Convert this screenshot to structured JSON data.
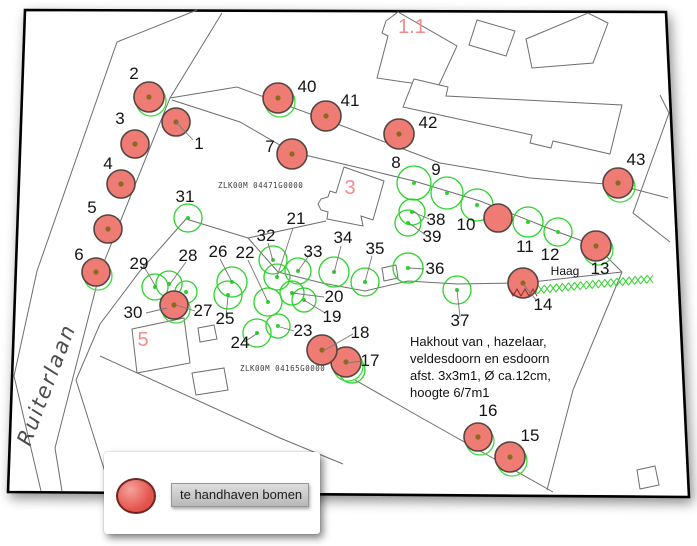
{
  "legend": {
    "label": "te handhaven bomen",
    "swatch_color": "#e4564d"
  },
  "map": {
    "frame": [
      [
        25,
        10
      ],
      [
        666,
        12
      ],
      [
        689,
        497
      ],
      [
        8,
        492
      ]
    ],
    "street": {
      "name": "Ruiterlaan",
      "x": 30,
      "y": 447,
      "rotation": -69
    },
    "haag": {
      "label": "Haag",
      "x": 565,
      "y": 275
    },
    "note": {
      "x": 410,
      "y": 346,
      "line_height": 17,
      "lines": [
        "Hakhout van , hazelaar,",
        "veldesdoorn en esdoorn",
        "afst. 3x3m1, Ø ca.12cm,",
        "hoogte 6/7m1"
      ]
    },
    "parcel_codes": [
      {
        "text": "ZLK00M 04471G0000",
        "x": 218,
        "y": 188
      },
      {
        "text": "ZLK00M 04165G0000",
        "x": 240,
        "y": 371
      }
    ],
    "red_refs": [
      {
        "t": "1.1",
        "x": 412,
        "y": 33,
        "size": 21
      },
      {
        "t": "3",
        "x": 350,
        "y": 194,
        "size": 21
      },
      {
        "t": "5",
        "x": 143,
        "y": 346,
        "size": 22
      }
    ],
    "roads": [
      [
        [
          197,
          10
        ],
        [
          117,
          42
        ],
        [
          37,
          271
        ],
        [
          14,
          376
        ],
        [
          41,
          491
        ]
      ],
      [
        [
          222,
          13
        ],
        [
          170,
          98
        ],
        [
          100,
          272
        ],
        [
          55,
          448
        ],
        [
          62,
          491
        ]
      ],
      [
        [
          326,
          221
        ],
        [
          248,
          238
        ],
        [
          186,
          219
        ],
        [
          140,
          271
        ],
        [
          100,
          324
        ],
        [
          76,
          380
        ],
        [
          111,
          491
        ]
      ],
      [
        [
          170,
          98
        ],
        [
          237,
          87
        ],
        [
          340,
          125
        ],
        [
          440,
          163
        ],
        [
          530,
          178
        ],
        [
          618,
          185
        ],
        [
          668,
          198
        ]
      ],
      [
        [
          172,
          100
        ],
        [
          240,
          122
        ],
        [
          292,
          152
        ],
        [
          360,
          168
        ],
        [
          414,
          181
        ],
        [
          480,
          201
        ],
        [
          558,
          232
        ],
        [
          596,
          246
        ],
        [
          622,
          272
        ]
      ],
      [
        [
          248,
          238
        ],
        [
          278,
          272
        ],
        [
          322,
          283
        ],
        [
          365,
          291
        ],
        [
          408,
          281
        ],
        [
          457,
          284
        ],
        [
          520,
          283
        ]
      ],
      [
        [
          523,
          283
        ],
        [
          622,
          272
        ]
      ],
      [
        [
          660,
          95
        ],
        [
          669,
          113
        ],
        [
          633,
          213
        ],
        [
          670,
          242
        ]
      ],
      [
        [
          100,
          356
        ],
        [
          280,
          438
        ],
        [
          343,
          464
        ]
      ],
      [
        [
          355,
          380
        ],
        [
          420,
          417
        ],
        [
          553,
          492
        ]
      ],
      [
        [
          622,
          272
        ],
        [
          573,
          390
        ],
        [
          547,
          490
        ]
      ]
    ],
    "buildings": [
      [
        [
          377,
          78
        ],
        [
          388,
          36
        ],
        [
          382,
          33
        ],
        [
          386,
          21
        ],
        [
          398,
          12
        ],
        [
          457,
          46
        ],
        [
          438,
          87
        ]
      ],
      [
        [
          477,
          20
        ],
        [
          515,
          31
        ],
        [
          506,
          56
        ],
        [
          469,
          45
        ]
      ],
      [
        [
          526,
          39
        ],
        [
          588,
          13
        ],
        [
          608,
          23
        ],
        [
          593,
          63
        ],
        [
          532,
          68
        ]
      ],
      [
        [
          403,
          107
        ],
        [
          414,
          79
        ],
        [
          448,
          87
        ],
        [
          446,
          96
        ],
        [
          622,
          105
        ],
        [
          610,
          154
        ],
        [
          553,
          141
        ],
        [
          551,
          148
        ],
        [
          530,
          143
        ],
        [
          532,
          135
        ]
      ],
      [
        [
          344,
          167
        ],
        [
          384,
          181
        ],
        [
          373,
          220
        ],
        [
          361,
          216
        ],
        [
          363,
          226
        ],
        [
          327,
          219
        ],
        [
          328,
          212
        ],
        [
          321,
          210
        ],
        [
          318,
          204
        ],
        [
          321,
          199
        ],
        [
          328,
          197
        ],
        [
          330,
          191
        ],
        [
          336,
          193
        ]
      ],
      [
        [
          132,
          329
        ],
        [
          184,
          318
        ],
        [
          190,
          363
        ],
        [
          137,
          373
        ]
      ],
      [
        [
          198,
          328
        ],
        [
          214,
          325
        ],
        [
          217,
          339
        ],
        [
          200,
          342
        ]
      ],
      [
        [
          192,
          373
        ],
        [
          224,
          368
        ],
        [
          228,
          390
        ],
        [
          196,
          395
        ]
      ],
      [
        [
          382,
          268
        ],
        [
          396,
          265
        ],
        [
          398,
          278
        ],
        [
          384,
          281
        ]
      ],
      [
        [
          637,
          470
        ],
        [
          655,
          466
        ],
        [
          659,
          485
        ],
        [
          640,
          489
        ]
      ]
    ],
    "hedge": {
      "x1": 535,
      "y1": 290,
      "x2": 650,
      "y2": 279
    },
    "trees_red": [
      {
        "n": "1",
        "x": 176,
        "y": 122,
        "r": 14,
        "halo": false
      },
      {
        "n": "2",
        "x": 149,
        "y": 97,
        "r": 15,
        "halo": true
      },
      {
        "n": "3",
        "x": 135,
        "y": 144,
        "r": 14,
        "halo": false
      },
      {
        "n": "4",
        "x": 121,
        "y": 184,
        "r": 14,
        "halo": false
      },
      {
        "n": "5",
        "x": 108,
        "y": 229,
        "r": 14,
        "halo": false
      },
      {
        "n": "6",
        "x": 96,
        "y": 272,
        "r": 14,
        "halo": true
      },
      {
        "n": "7",
        "x": 292,
        "y": 154,
        "r": 15,
        "halo": false
      },
      {
        "n": "10",
        "x": 498,
        "y": 218,
        "r": 14,
        "halo": false,
        "dot": false
      },
      {
        "n": "13",
        "x": 596,
        "y": 246,
        "r": 15,
        "halo": true
      },
      {
        "n": "14",
        "x": 523,
        "y": 283,
        "r": 15,
        "halo": false,
        "hatch": true
      },
      {
        "n": "15",
        "x": 510,
        "y": 457,
        "r": 15,
        "halo": true
      },
      {
        "n": "16",
        "x": 478,
        "y": 437,
        "r": 14,
        "halo": true
      },
      {
        "n": "17",
        "x": 346,
        "y": 362,
        "r": 15,
        "halo": true
      },
      {
        "n": "18",
        "x": 322,
        "y": 350,
        "r": 15,
        "halo": false
      },
      {
        "n": "27",
        "x": 174,
        "y": 305,
        "r": 14,
        "halo": true
      },
      {
        "n": "40",
        "x": 278,
        "y": 98,
        "r": 15,
        "halo": true
      },
      {
        "n": "41",
        "x": 326,
        "y": 116,
        "r": 15,
        "halo": false
      },
      {
        "n": "42",
        "x": 399,
        "y": 134,
        "r": 15,
        "halo": false
      },
      {
        "n": "43",
        "x": 618,
        "y": 183,
        "r": 15,
        "halo": true
      }
    ],
    "trees_green": [
      {
        "n": "8",
        "x": 414,
        "y": 183,
        "r": 17
      },
      {
        "n": "9",
        "x": 447,
        "y": 193,
        "r": 16
      },
      {
        "n": "",
        "x": 477,
        "y": 205,
        "r": 16
      },
      {
        "n": "11",
        "x": 528,
        "y": 222,
        "r": 15
      },
      {
        "n": "12",
        "x": 558,
        "y": 232,
        "r": 14
      },
      {
        "n": "38",
        "x": 412,
        "y": 212,
        "r": 13
      },
      {
        "n": "39",
        "x": 408,
        "y": 223,
        "r": 13
      },
      {
        "n": "31",
        "x": 188,
        "y": 218,
        "r": 14
      },
      {
        "n": "36",
        "x": 408,
        "y": 268,
        "r": 15
      },
      {
        "n": "37",
        "x": 457,
        "y": 290,
        "r": 14
      },
      {
        "n": "29",
        "x": 155,
        "y": 287,
        "r": 13
      },
      {
        "n": "28",
        "x": 169,
        "y": 284,
        "r": 13
      },
      {
        "n": "",
        "x": 186,
        "y": 292,
        "r": 11
      },
      {
        "n": "26",
        "x": 232,
        "y": 282,
        "r": 15
      },
      {
        "n": "25",
        "x": 228,
        "y": 295,
        "r": 14
      },
      {
        "n": "22",
        "x": 268,
        "y": 302,
        "r": 14
      },
      {
        "n": "32",
        "x": 273,
        "y": 260,
        "r": 14
      },
      {
        "n": "21",
        "x": 277,
        "y": 277,
        "r": 13
      },
      {
        "n": "33",
        "x": 298,
        "y": 271,
        "r": 13
      },
      {
        "n": "34",
        "x": 334,
        "y": 272,
        "r": 15
      },
      {
        "n": "35",
        "x": 365,
        "y": 282,
        "r": 14
      },
      {
        "n": "20",
        "x": 292,
        "y": 293,
        "r": 12
      },
      {
        "n": "19",
        "x": 304,
        "y": 300,
        "r": 12
      },
      {
        "n": "24",
        "x": 257,
        "y": 333,
        "r": 14
      },
      {
        "n": "23",
        "x": 278,
        "y": 326,
        "r": 12
      },
      {
        "n": "",
        "x": 352,
        "y": 370,
        "r": 13
      }
    ],
    "leaders": [
      [
        176,
        122,
        193,
        140
      ],
      [
        523,
        284,
        537,
        301
      ],
      [
        347,
        363,
        362,
        361
      ],
      [
        323,
        351,
        353,
        334
      ],
      [
        304,
        300,
        325,
        313
      ],
      [
        292,
        293,
        324,
        297
      ],
      [
        277,
        277,
        293,
        228
      ],
      [
        268,
        302,
        248,
        260
      ],
      [
        280,
        327,
        294,
        331
      ],
      [
        258,
        333,
        244,
        342
      ],
      [
        228,
        296,
        226,
        317
      ],
      [
        232,
        282,
        220,
        259
      ],
      [
        176,
        305,
        195,
        311
      ],
      [
        170,
        284,
        186,
        262
      ],
      [
        156,
        287,
        143,
        265
      ],
      [
        167,
        308,
        146,
        313
      ],
      [
        273,
        261,
        268,
        243
      ],
      [
        298,
        271,
        310,
        254
      ],
      [
        334,
        273,
        341,
        246
      ],
      [
        365,
        282,
        372,
        256
      ],
      [
        409,
        268,
        424,
        269
      ],
      [
        457,
        290,
        460,
        317
      ],
      [
        413,
        212,
        429,
        219
      ],
      [
        409,
        223,
        427,
        236
      ]
    ],
    "labels": [
      {
        "t": "1",
        "x": 199,
        "y": 149
      },
      {
        "t": "2",
        "x": 134,
        "y": 79
      },
      {
        "t": "3",
        "x": 120,
        "y": 124
      },
      {
        "t": "4",
        "x": 108,
        "y": 169
      },
      {
        "t": "5",
        "x": 92,
        "y": 213
      },
      {
        "t": "6",
        "x": 79,
        "y": 260
      },
      {
        "t": "7",
        "x": 270,
        "y": 152
      },
      {
        "t": "8",
        "x": 396,
        "y": 168
      },
      {
        "t": "9",
        "x": 436,
        "y": 175
      },
      {
        "t": "10",
        "x": 466,
        "y": 230
      },
      {
        "t": "11",
        "x": 525,
        "y": 252
      },
      {
        "t": "12",
        "x": 550,
        "y": 260
      },
      {
        "t": "13",
        "x": 600,
        "y": 274
      },
      {
        "t": "14",
        "x": 543,
        "y": 310
      },
      {
        "t": "15",
        "x": 530,
        "y": 441
      },
      {
        "t": "16",
        "x": 488,
        "y": 416
      },
      {
        "t": "17",
        "x": 370,
        "y": 366
      },
      {
        "t": "18",
        "x": 360,
        "y": 338
      },
      {
        "t": "19",
        "x": 332,
        "y": 322
      },
      {
        "t": "20",
        "x": 334,
        "y": 302
      },
      {
        "t": "21",
        "x": 296,
        "y": 224
      },
      {
        "t": "22",
        "x": 245,
        "y": 258
      },
      {
        "t": "23",
        "x": 303,
        "y": 336
      },
      {
        "t": "24",
        "x": 240,
        "y": 348
      },
      {
        "t": "25",
        "x": 225,
        "y": 324
      },
      {
        "t": "26",
        "x": 218,
        "y": 257
      },
      {
        "t": "27",
        "x": 203,
        "y": 316
      },
      {
        "t": "28",
        "x": 188,
        "y": 261
      },
      {
        "t": "29",
        "x": 139,
        "y": 269
      },
      {
        "t": "30",
        "x": 133,
        "y": 318
      },
      {
        "t": "31",
        "x": 185,
        "y": 202
      },
      {
        "t": "32",
        "x": 266,
        "y": 241
      },
      {
        "t": "33",
        "x": 313,
        "y": 257
      },
      {
        "t": "34",
        "x": 343,
        "y": 243
      },
      {
        "t": "35",
        "x": 375,
        "y": 254
      },
      {
        "t": "36",
        "x": 435,
        "y": 274
      },
      {
        "t": "37",
        "x": 460,
        "y": 326
      },
      {
        "t": "38",
        "x": 436,
        "y": 225
      },
      {
        "t": "39",
        "x": 432,
        "y": 242
      },
      {
        "t": "40",
        "x": 307,
        "y": 92
      },
      {
        "t": "41",
        "x": 350,
        "y": 106
      },
      {
        "t": "42",
        "x": 428,
        "y": 128
      },
      {
        "t": "43",
        "x": 636,
        "y": 165
      }
    ]
  }
}
